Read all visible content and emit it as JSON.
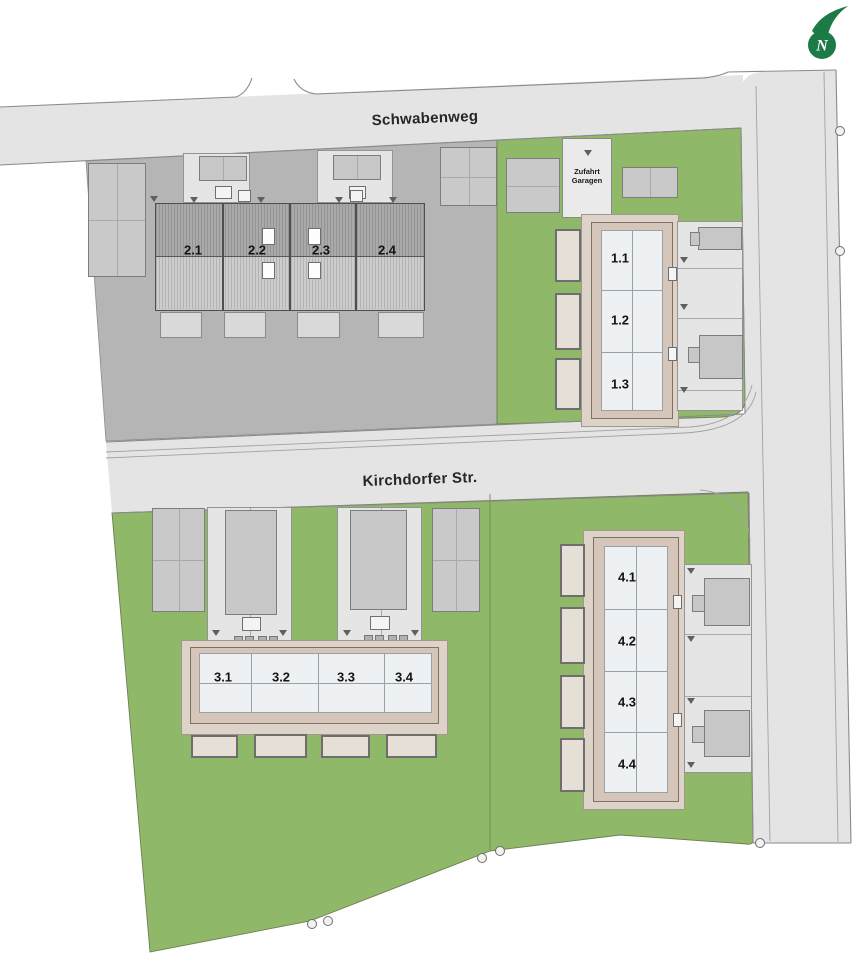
{
  "compass": {
    "letter": "N",
    "color": "#1c7a46"
  },
  "streets": {
    "schwabenweg": {
      "label": "Schwabenweg"
    },
    "kirchdorfer": {
      "label": "Kirchdorfer Str."
    }
  },
  "garage_access": {
    "line1": "Zufahrt",
    "line2": "Garagen"
  },
  "buildings": {
    "house1": {
      "units": [
        {
          "label": "1.1"
        },
        {
          "label": "1.2"
        },
        {
          "label": "1.3"
        }
      ]
    },
    "house2": {
      "units": [
        {
          "label": "2.1"
        },
        {
          "label": "2.2"
        },
        {
          "label": "2.3"
        },
        {
          "label": "2.4"
        }
      ]
    },
    "house3": {
      "units": [
        {
          "label": "3.1"
        },
        {
          "label": "3.2"
        },
        {
          "label": "3.3"
        },
        {
          "label": "3.4"
        }
      ]
    },
    "house4": {
      "units": [
        {
          "label": "4.1"
        },
        {
          "label": "4.2"
        },
        {
          "label": "4.3"
        },
        {
          "label": "4.4"
        }
      ]
    }
  },
  "colors": {
    "lawn_green": "#8fb968",
    "road_gray": "#e4e4e4",
    "plot_gray": "#b5b5b5",
    "roof_hatch_dark": "#9a9a9a",
    "roof_hatch_light": "#c6c6c6",
    "roof_frame_tan": "#d5c6b9",
    "floor_light": "#eef1f3",
    "garage_beige": "#e6dfd6",
    "logo_green": "#1c7a46"
  }
}
